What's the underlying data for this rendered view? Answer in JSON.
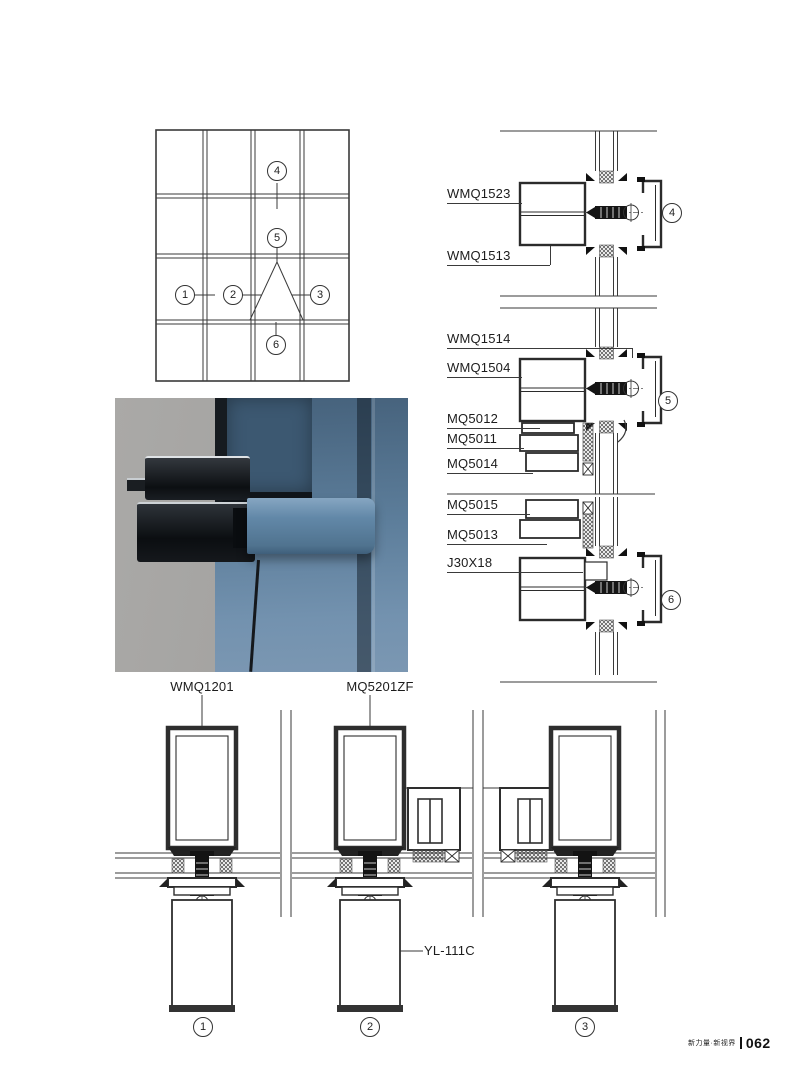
{
  "footer": {
    "tagline": "新力量·新视界",
    "page_number": "062"
  },
  "labels": {
    "wmq1523": "WMQ1523",
    "wmq1513": "WMQ1513",
    "wmq1514": "WMQ1514",
    "wmq1504": "WMQ1504",
    "mq5012": "MQ5012",
    "mq5011": "MQ5011",
    "mq5014": "MQ5014",
    "mq5015": "MQ5015",
    "mq5013": "MQ5013",
    "j30x18": "J30X18",
    "wmq1201": "WMQ1201",
    "mq5201zf": "MQ5201ZF",
    "yl111c": "YL-111C"
  },
  "callouts": {
    "elevation": [
      "1",
      "2",
      "3",
      "4",
      "5",
      "6"
    ],
    "sections": [
      "4",
      "5",
      "6"
    ],
    "plans": [
      "1",
      "2",
      "3"
    ]
  },
  "colors": {
    "line": "#3a3a3a",
    "text": "#1c1c1c",
    "glass_blue": "#5f7f9c",
    "photo_bg": "#a8a7a4",
    "profile_dark": "#15181c"
  }
}
